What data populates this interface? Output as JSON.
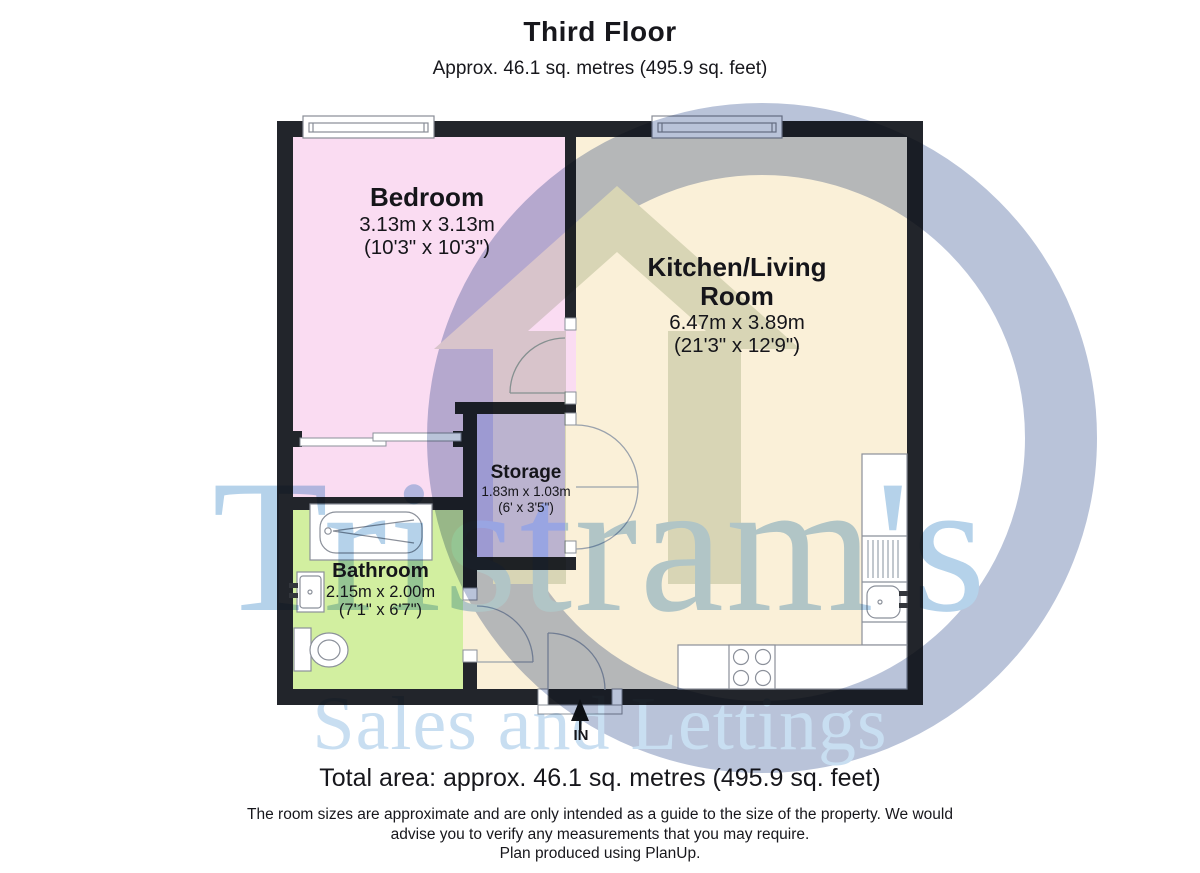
{
  "header": {
    "title": "Third Floor",
    "subtitle": "Approx. 46.1 sq. metres (495.9 sq. feet)"
  },
  "rooms": [
    {
      "name": "Bedroom",
      "dim_metric": "3.13m x 3.13m",
      "dim_imperial": "(10'3\" x 10'3\")",
      "color": "#fadcf2"
    },
    {
      "name": "Kitchen/Living Room",
      "dim_metric": "6.47m x 3.89m",
      "dim_imperial": "(21'3\" x 12'9\")",
      "color": "#faf0d8"
    },
    {
      "name": "Storage",
      "dim_metric": "1.83m x 1.03m",
      "dim_imperial": "(6' x 3'5\")",
      "color": "#d8c9f7"
    },
    {
      "name": "Bathroom",
      "dim_metric": "2.15m x 2.00m",
      "dim_imperial": "(7'1\" x 6'7\")",
      "color": "#d2efa0"
    }
  ],
  "entrance": {
    "label": "IN"
  },
  "footer": {
    "total_area": "Total area: approx. 46.1 sq. metres (495.9 sq. feet)",
    "disclaimer_line1": "The room sizes are approximate and are only intended as a guide to the size of the property. We would",
    "disclaimer_line2": "advise you to verify any measurements that you may require.",
    "produced_by": "Plan produced using PlanUp."
  },
  "watermark": {
    "name": "Tristram's",
    "tagline": "Sales and Lettings",
    "text_color": "#b5d2ea",
    "tagline_color": "#c8def1",
    "ring_color": "#b9c3d9",
    "house_color": "#dde3d6"
  },
  "palette": {
    "wall": "#22252b",
    "fixture_stroke": "#8b909a",
    "door_arc": "#9aa2ac"
  }
}
